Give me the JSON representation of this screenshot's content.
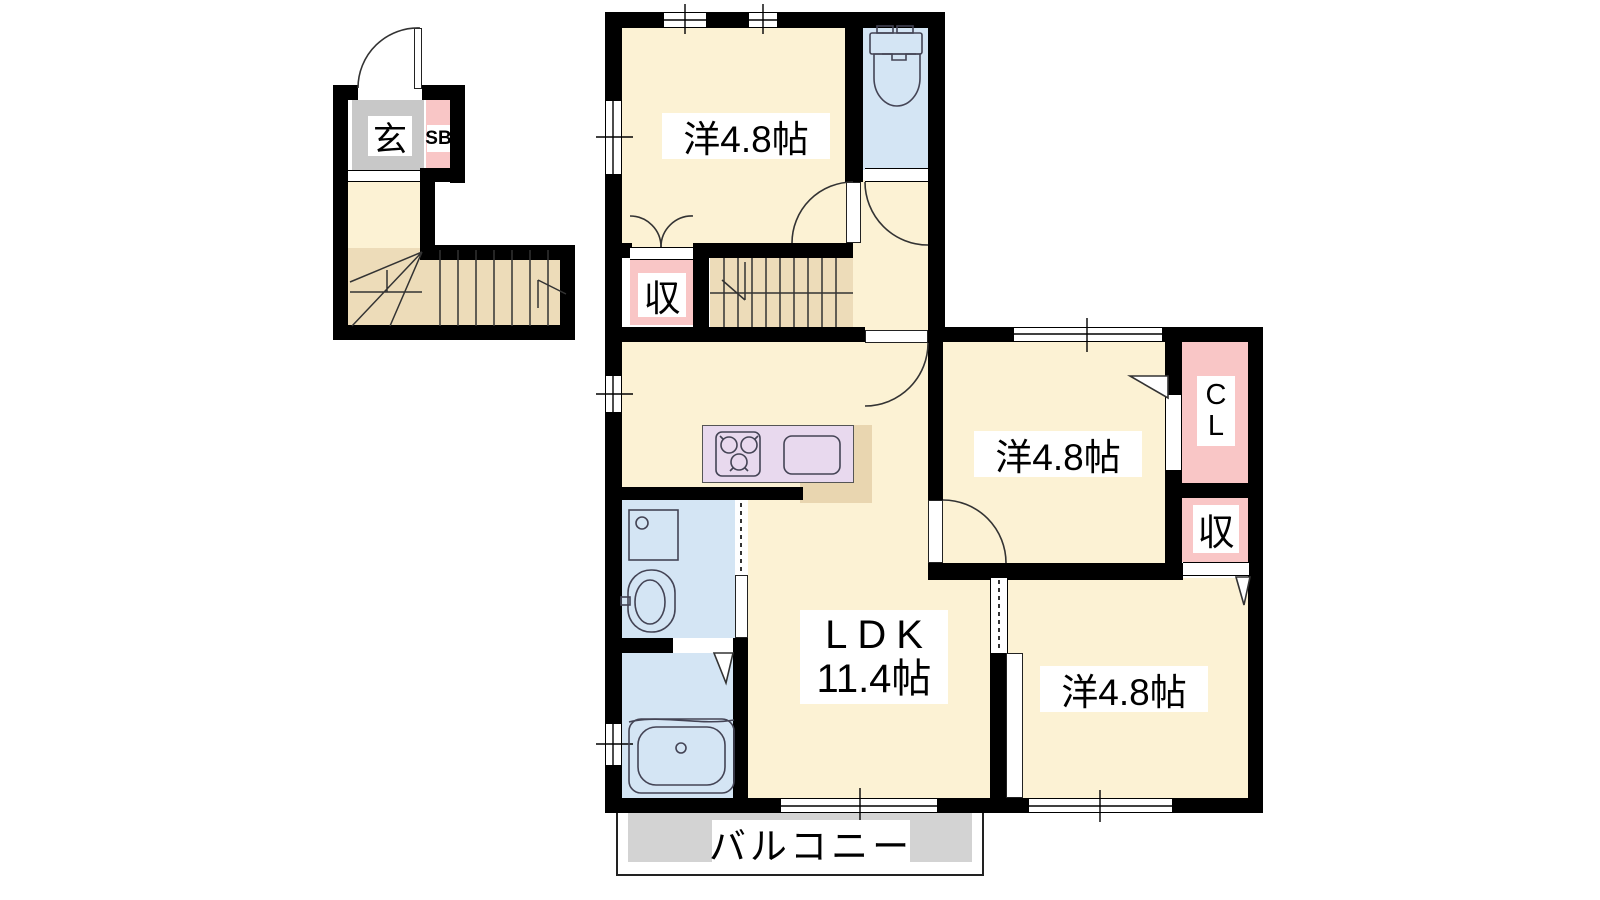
{
  "floorplan": {
    "labels": {
      "entrance": "玄",
      "shoe_box": "SB",
      "hall_storage": "収",
      "room_top": "洋4.8帖",
      "room_middle": "洋4.8帖",
      "room_bottom": "洋4.8帖",
      "closet": "CL",
      "right_storage": "収",
      "ldk_name": "LDK",
      "ldk_size": "11.4帖",
      "balcony": "バルコニー"
    },
    "colors": {
      "wall": "#000000",
      "room_floor": "#fcf2d4",
      "stairs": "#eddcb9",
      "kitchen_back": "#e9d6b0",
      "storage_pink": "#f9c6c6",
      "sanitary": "#d4e5f4",
      "kitchen_counter": "#e8d9ee",
      "entrance_gray": "#c8c8c8",
      "balcony_gray": "#d3d3d3"
    }
  }
}
